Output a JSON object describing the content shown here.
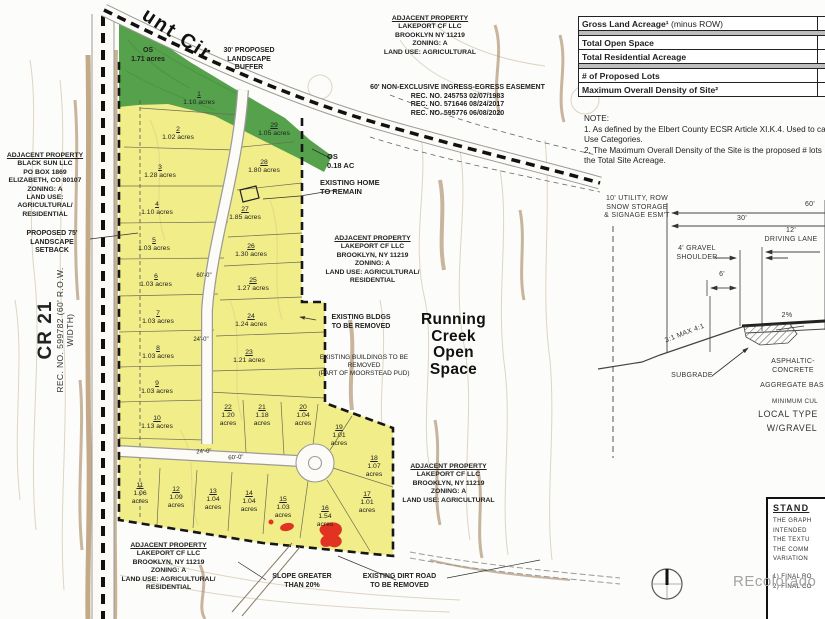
{
  "map": {
    "street_label": "unt Cir",
    "cr21": {
      "name": "CR 21",
      "rec": "REC. NO. 599782",
      "row": "(60' R.O.W. WIDTH)"
    },
    "lots": [
      {
        "n": "1",
        "a": "1.10 acres"
      },
      {
        "n": "2",
        "a": "1.02 acres"
      },
      {
        "n": "3",
        "a": "1.28 acres"
      },
      {
        "n": "4",
        "a": "1.10 acres"
      },
      {
        "n": "5",
        "a": "1.03 acres"
      },
      {
        "n": "6",
        "a": "1.03 acres"
      },
      {
        "n": "7",
        "a": "1.03 acres"
      },
      {
        "n": "8",
        "a": "1.03 acres"
      },
      {
        "n": "9",
        "a": "1.03 acres"
      },
      {
        "n": "10",
        "a": "1.13 acres"
      },
      {
        "n": "11",
        "a": "1.06 acres"
      },
      {
        "n": "12",
        "a": "1.09 acres"
      },
      {
        "n": "13",
        "a": "1.04 acres"
      },
      {
        "n": "14",
        "a": "1.04 acres"
      },
      {
        "n": "15",
        "a": "1.03 acres"
      },
      {
        "n": "16",
        "a": "1.54 acres"
      },
      {
        "n": "17",
        "a": "1.01 acres"
      },
      {
        "n": "18",
        "a": "1.07 acres"
      },
      {
        "n": "19",
        "a": "1.01 acres"
      },
      {
        "n": "20",
        "a": "1.04 acres"
      },
      {
        "n": "21",
        "a": "1.18 acres"
      },
      {
        "n": "22",
        "a": "1.20 acres"
      },
      {
        "n": "23",
        "a": "1.21 acres"
      },
      {
        "n": "24",
        "a": "1.24 acres"
      },
      {
        "n": "25",
        "a": "1.27 acres"
      },
      {
        "n": "26",
        "a": "1.30 acres"
      },
      {
        "n": "27",
        "a": "1.85 acres"
      },
      {
        "n": "28",
        "a": "1.80 acres"
      },
      {
        "n": "29",
        "a": "1.05 acres"
      }
    ],
    "labels": {
      "buffer": {
        "text": "30' PROPOSED\nLANDSCAPE\nBUFFER"
      },
      "ap_top": {
        "title": "ADJACENT PROPERTY",
        "text": "LAKEPORT CF LLC\nBROOKLYN NY 11219\nZONING: A\nLAND USE: AGRICULTURAL"
      },
      "easement": {
        "text": "60' NON-EXCLUSIVE INGRESS-EGRESS EASEMENT\nREC. NO. 245753 02/07/1983\nREC. NO. 571646 08/24/2017\nREC. NO. 595776 06/08/2020"
      },
      "ap_left": {
        "title": "ADJACENT PROPERTY",
        "text": "BLACK SUN LLC\nPO BOX 1869\nELIZABETH, CO 80107\nZONING: A\nLAND USE: AGRICULTURAL/\nRESIDENTIAL"
      },
      "setback": {
        "text": "PROPOSED 75'\nLANDSCAPE SETBACK"
      },
      "os1": {
        "text": "OS\n1.71 acres"
      },
      "os2": {
        "text": "OS\n0.18 AC"
      },
      "home": {
        "text": "EXISTING HOME\nTO REMAIN"
      },
      "ap_mid": {
        "title": "ADJACENT PROPERTY",
        "text": "LAKEPORT CF LLC\nBROOKLYN, NY 11219\nZONING: A\nLAND USE: AGRICULTURAL/\nRESIDENTIAL"
      },
      "bldgs": {
        "text": "EXISTING BLDGS\nTO BE REMOVED"
      },
      "pud": {
        "text": "EXISTING BUILDINGS TO BE\nREMOVED\n(PART OF MOORSTEAD PUD)"
      },
      "rcos": {
        "text": "Running\nCreek\nOpen\nSpace"
      },
      "ap_right": {
        "title": "ADJACENT PROPERTY",
        "text": "LAKEPORT CF LLC\nBROOKLYN, NY 11219\nZONING: A\nLAND USE: AGRICULTURAL"
      },
      "ap_bottom": {
        "title": "ADJACENT PROPERTY",
        "text": "LAKEPORT CF LLC\nBROOKLYN, NY 11219\nZONING: A\nLAND USE: AGRICULTURAL/\nRESIDENTIAL"
      },
      "slope": {
        "text": "SLOPE GREATER\nTHAN 20%"
      },
      "dirt": {
        "text": "EXISTING DIRT ROAD\nTO BE REMOVED"
      },
      "dim_a": {
        "text": "60'-0\""
      },
      "dim_b": {
        "text": "24'-0\""
      },
      "dim_c": {
        "text": "24'-0\""
      },
      "dim_d": {
        "text": "60'-0\""
      }
    }
  },
  "cross_section": {
    "utility": "10' UTILITY,  ROW\nSNOW STORAGE\n& SIGNAGE ESM'T",
    "dim60": "60'",
    "dim30": "30'",
    "lane": "12'\nDRIVING LANE",
    "gravel": "4' GRAVEL\nSHOULDER",
    "dim6": "6'",
    "pct": "2%",
    "ratio": "3:1 MAX 4:1",
    "subgrade": "SUBGRADE",
    "asphalt": "ASPHALTIC-\nCONCRETE",
    "aggregate": "AGGREGATE BAS",
    "minimum": "MINIMUM CUL",
    "local": "LOCAL TYPE",
    "wgravel": "W/GRAVEL"
  },
  "summary_table": {
    "rows": [
      {
        "bold": "Gross Land Acreage¹",
        "rest": " (minus ROW)"
      },
      {
        "bold": "Total Open Space",
        "rest": ""
      },
      {
        "bold": "Total Residential Acreage",
        "rest": ""
      },
      {
        "bold": "# of Proposed Lots",
        "rest": ""
      },
      {
        "bold": "Maximum Overall Density of Site²",
        "rest": ""
      }
    ]
  },
  "notes": {
    "lines": [
      "NOTE:",
      "1. As defined by the Elbert County ECSR Article XI.K.4. Used to ca",
      "Use Categories.",
      "2. The Maximum Overall Density of the Site is the proposed # lots",
      "the Total Site Acreage."
    ]
  },
  "standard_box": {
    "title": "STAND",
    "lines": [
      "THE GRAPH",
      "INTENDED",
      "THE TEXTU",
      "THE COMM",
      "VARIATION",
      "1) FINAL RO",
      "2) FINAL CO"
    ]
  },
  "watermark": "REcolorado",
  "colors": {
    "lot_yellow": "#f1ed88",
    "open_space_green": "#56a14b",
    "boundary": "#161616",
    "terrain_tan": "#b4946a",
    "redline": "#e23222"
  }
}
